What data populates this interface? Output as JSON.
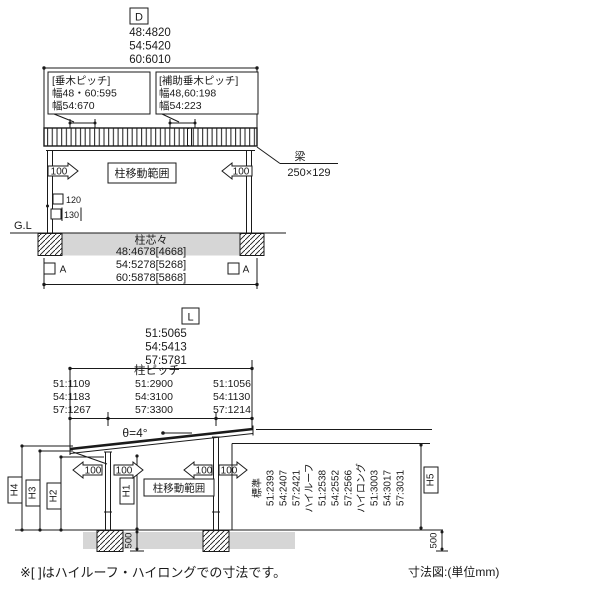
{
  "front_view": {
    "section_label": "D",
    "width_dims": [
      "48:4820",
      "54:5420",
      "60:6010"
    ],
    "rafter_pitch": {
      "title": "[垂木ピッチ]",
      "line1": "幅48・60:595",
      "line2": "幅54:670"
    },
    "aux_rafter_pitch": {
      "title": "[補助垂木ピッチ]",
      "line1": "幅48,60:198",
      "line2": "幅54:223"
    },
    "beam": {
      "label": "梁",
      "size": "250×129"
    },
    "post_move": "100",
    "post_move_range_label": "柱移動範囲",
    "post_section_dims": [
      "120",
      "130"
    ],
    "ground_label": "G.L",
    "post_span_label": "柱芯々",
    "post_span_dims": [
      "48:4678[4668]",
      "54:5278[5268]",
      "60:5878[5868]"
    ],
    "section_marker": "A"
  },
  "side_view": {
    "section_label": "L",
    "length_dims": [
      "51:5065",
      "54:5413",
      "57:5781"
    ],
    "post_pitch_label": "柱ピッチ",
    "front_overhang_dims": [
      "51:1109",
      "54:1183",
      "57:1267"
    ],
    "post_span_dims": [
      "51:2900",
      "54:3100",
      "57:3300"
    ],
    "rear_overhang_dims": [
      "51:1056",
      "54:1130",
      "57:1214"
    ],
    "roof_slope": "θ=4°",
    "post_move": "100",
    "post_move_range_label": "柱移動範囲",
    "height_labels": {
      "h1": "H1",
      "h2": "H2",
      "h3": "H3",
      "h4": "H4",
      "h5": "H5"
    },
    "height_table": [
      "標準",
      "51:2393",
      "54:2407",
      "57:2421",
      "ハイルーフ",
      "51:2538",
      "54:2552",
      "57:2566",
      "ハイロング",
      "51:3003",
      "54:3017",
      "57:3031"
    ],
    "foundation_depth": "500"
  },
  "notes": {
    "footnote": "※[ ]はハイルーフ・ハイロングでの寸法です。",
    "caption": "寸法図:(単位mm)"
  },
  "colors": {
    "line": "#1a1a1a",
    "ground_fill": "#d6d6d6",
    "background": "#ffffff"
  }
}
